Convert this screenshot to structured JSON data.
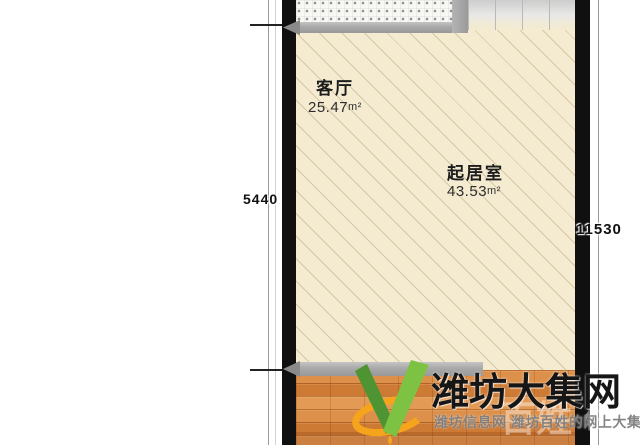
{
  "floorplan": {
    "rooms": [
      {
        "name": "客厅",
        "area": "25.47",
        "unit": "m²"
      },
      {
        "name": "起居室",
        "area": "43.53",
        "unit": "m²"
      }
    ],
    "dimensions": {
      "left": "5440",
      "right": "11530"
    },
    "colors": {
      "wall": "#101010",
      "floor_hatch": "#f4ebd1",
      "wood_floor": "#d8873f",
      "sill_gray": "#a9a9a9"
    }
  },
  "watermark": {
    "title": "潍坊大集网",
    "subtitle": "潍坊信息网 潍坊百姓的网上大集",
    "faint_text_1": "百姓",
    "faint_text_2": "住",
    "logo_colors": {
      "green_dark": "#4f9432",
      "green_light": "#7dc242",
      "orange": "#f7a41d"
    }
  }
}
